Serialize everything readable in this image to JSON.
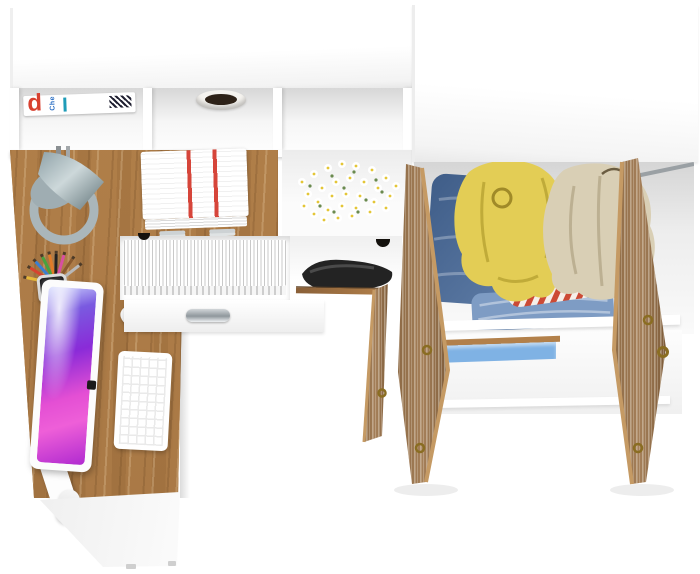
{
  "meta": {
    "description": "Top-down product render: white-and-oak corner desk with hutch (monitor, keyboard, mouse, lamp, magazines, books, daisies, paper tray, pencil cup, open drawers) joined to an open white wardrobe with oak doors containing clothes",
    "background": "#ffffff"
  },
  "palette": {
    "wood-mid": "#b2804a",
    "wood-deep": "#a87845",
    "wood-door": "#97714a",
    "door-edge": "#c59a64",
    "mag-red": "#d8402f",
    "mag-blue": "#2b6fc4",
    "foliage": "#2e2218",
    "doc-red": "#d6453a",
    "screen-a": "#cfd8ff",
    "screen-b": "#8a2bd8",
    "screen-c": "#e44fd4",
    "screen-d": "#b02ad0",
    "daisy-center": "#e4c637",
    "leaf-green": "#6a8a4f",
    "lamp-steel": "#8fa2a8",
    "lamp-steel-dark": "#5f7277",
    "denim-a": "#3f5d88",
    "denim-b": "#5e7ca6",
    "jeans-light": "#7e9cc4",
    "jacket-yellow": "#e3cd55",
    "jacket-fold": "#c0ab39",
    "coat-beige": "#d9cfb5",
    "coat-fold": "#bcb092",
    "shirt-red": "#cc4a35",
    "shelf-blue": "#7fb2e4",
    "hinge-gold": "#8a6d22",
    "metal": "#9aa0a4",
    "headphone-dark": "#232323"
  },
  "hutch": {
    "magazine": {
      "cover_letter": "d",
      "cover_word": "Che"
    },
    "magazine_edge_colors": [
      "#e2572f",
      "#f0c93c",
      "#d8498e",
      "#4a7fc1",
      "#39b6b0"
    ],
    "book_spine_colors": [
      "#a23431",
      "#3a2a22",
      "#2b4f9e",
      "#17171c",
      "#2f5c33",
      "#6b2420",
      "#d8d1bc",
      "#1f9cb8"
    ]
  },
  "desk": {
    "pencil_colors": [
      "#e6b93a",
      "#d8432f",
      "#3a7fd0",
      "#47a23f",
      "#e07b28",
      "#222222",
      "#d84fa0",
      "#8a5a2f",
      "#b8b8b8"
    ],
    "notebook_tab_colors": [
      "#e660a8",
      "#8a4fd0",
      "#f0e04a",
      "#f09a3a",
      "#57b84a",
      "#3a7fd0",
      "#d8432f",
      "#2ab5a8",
      "#e660a8",
      "#f0e04a",
      "#3a7fd0",
      "#57b84a"
    ]
  }
}
